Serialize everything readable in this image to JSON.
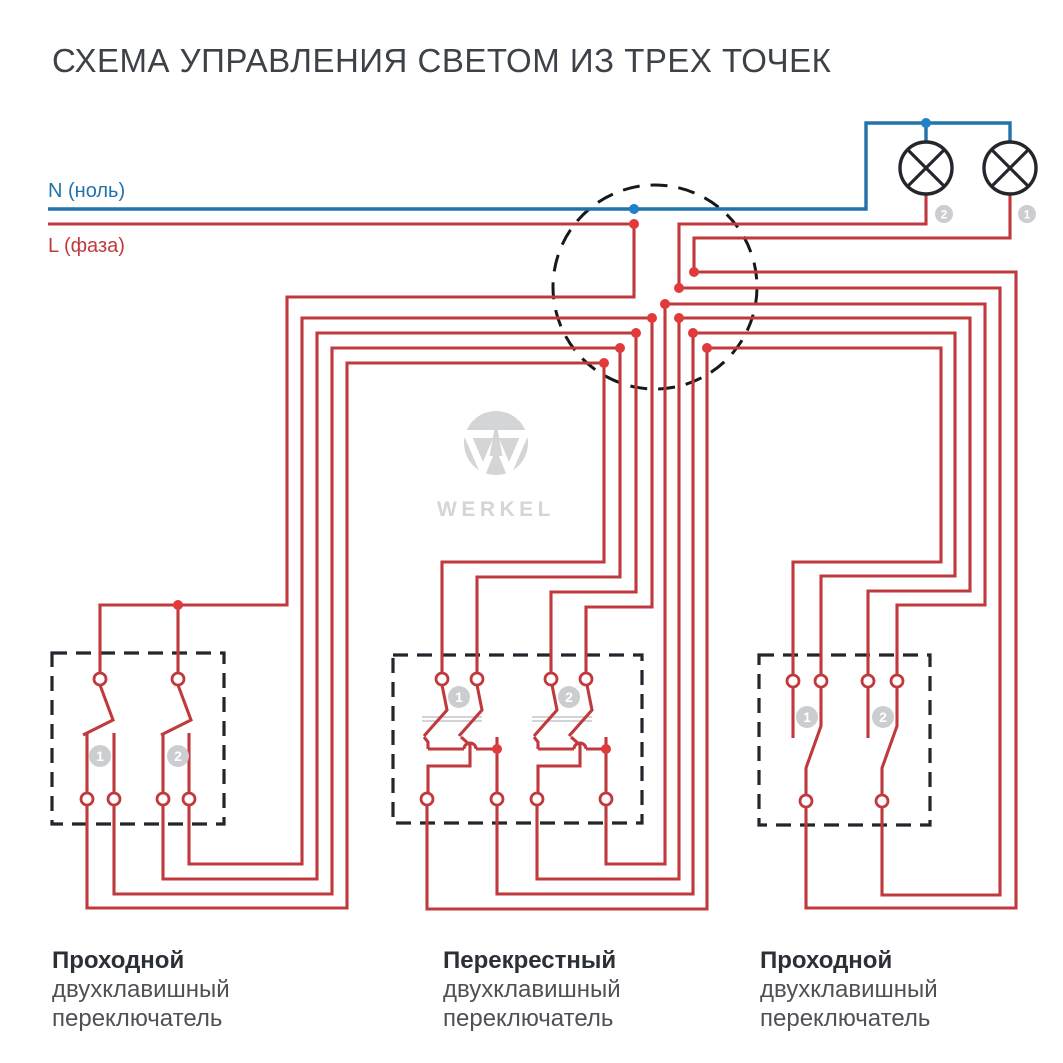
{
  "title": "СХЕМА УПРАВЛЕНИЯ СВЕТОМ ИЗ ТРЕХ ТОЧЕК",
  "wire_labels": {
    "neutral": "N (ноль)",
    "phase": "L (фаза)"
  },
  "logo": {
    "text": "WERKEL"
  },
  "switch_captions": [
    {
      "line1": "Проходной",
      "line2": "двухклавишный",
      "line3": "переключатель"
    },
    {
      "line1": "Перекрестный",
      "line2": "двухклавишный",
      "line3": "переключатель"
    },
    {
      "line1": "Проходной",
      "line2": "двухклавишный",
      "line3": "переключатель"
    }
  ],
  "colors": {
    "red": "#c03a3d",
    "red_dot": "#e13a3a",
    "blue": "#2173a9",
    "blue_dot": "#2080c8",
    "dark": "#23262c",
    "junction": "#16181c",
    "badge": "#cbcdd0",
    "badge_text": "#ffffff",
    "logo_gray": "#d3d5d7",
    "coupler": "#b9bbbd"
  },
  "diagram": {
    "boxes": [
      {
        "x": 52,
        "y": 653,
        "w": 172,
        "h": 171
      },
      {
        "x": 393,
        "y": 655,
        "w": 249,
        "h": 168
      },
      {
        "x": 759,
        "y": 655,
        "w": 171,
        "h": 170
      }
    ],
    "junction": {
      "cx": 655,
      "cy": 287,
      "r": 102
    },
    "lamps": [
      {
        "cx": 926,
        "cy": 168,
        "r": 26
      },
      {
        "cx": 1010,
        "cy": 168,
        "r": 26
      }
    ],
    "blue_wires": [
      [
        [
          48,
          209
        ],
        [
          866,
          209
        ],
        [
          866,
          123
        ],
        [
          1010,
          123
        ],
        [
          1010,
          142
        ]
      ],
      [
        [
          926,
          123
        ],
        [
          926,
          142
        ]
      ]
    ],
    "red_wires": [
      [
        [
          48,
          224
        ],
        [
          634,
          224
        ]
      ],
      [
        [
          634,
          224
        ],
        [
          634,
          297
        ],
        [
          287,
          297
        ],
        [
          287,
          605
        ],
        [
          100,
          605
        ],
        [
          100,
          673
        ]
      ],
      [
        [
          178,
          605
        ],
        [
          178,
          673
        ]
      ],
      [
        [
          100,
          685
        ],
        [
          113,
          720
        ],
        [
          83,
          735
        ]
      ],
      [
        [
          178,
          685
        ],
        [
          191,
          720
        ],
        [
          161,
          735
        ]
      ],
      [
        [
          87,
          733
        ],
        [
          87,
          793
        ]
      ],
      [
        [
          114,
          733
        ],
        [
          114,
          793
        ]
      ],
      [
        [
          163,
          733
        ],
        [
          163,
          793
        ]
      ],
      [
        [
          189,
          733
        ],
        [
          189,
          793
        ]
      ],
      [
        [
          87,
          805
        ],
        [
          87,
          908
        ],
        [
          347,
          908
        ],
        [
          347,
          363
        ],
        [
          604,
          363
        ]
      ],
      [
        [
          114,
          805
        ],
        [
          114,
          894
        ],
        [
          332,
          894
        ],
        [
          332,
          348
        ],
        [
          620,
          348
        ]
      ],
      [
        [
          163,
          805
        ],
        [
          163,
          879
        ],
        [
          317,
          879
        ],
        [
          317,
          333
        ],
        [
          636,
          333
        ]
      ],
      [
        [
          189,
          805
        ],
        [
          189,
          864
        ],
        [
          302,
          864
        ],
        [
          302,
          318
        ],
        [
          652,
          318
        ]
      ],
      [
        [
          604,
          363
        ],
        [
          604,
          562
        ],
        [
          442,
          562
        ],
        [
          442,
          673
        ]
      ],
      [
        [
          620,
          348
        ],
        [
          620,
          577
        ],
        [
          477,
          577
        ],
        [
          477,
          673
        ]
      ],
      [
        [
          636,
          333
        ],
        [
          636,
          592
        ],
        [
          551,
          592
        ],
        [
          551,
          673
        ]
      ],
      [
        [
          652,
          318
        ],
        [
          652,
          607
        ],
        [
          586,
          607
        ],
        [
          586,
          673
        ]
      ],
      [
        [
          442,
          685
        ],
        [
          447,
          710
        ],
        [
          424,
          736
        ]
      ],
      [
        [
          477,
          685
        ],
        [
          482,
          710
        ],
        [
          459,
          736
        ]
      ],
      [
        [
          552,
          685
        ],
        [
          557,
          710
        ],
        [
          534,
          736
        ]
      ],
      [
        [
          587,
          685
        ],
        [
          592,
          710
        ],
        [
          569,
          736
        ]
      ],
      [
        [
          424,
          737
        ],
        [
          428,
          742
        ],
        [
          428,
          749
        ]
      ],
      [
        [
          428,
          749
        ],
        [
          464,
          749
        ]
      ],
      [
        [
          476,
          749
        ],
        [
          497,
          749
        ]
      ],
      [
        [
          497,
          749
        ],
        [
          497,
          737
        ]
      ],
      [
        [
          497,
          749
        ],
        [
          497,
          793
        ]
      ],
      [
        [
          461,
          737
        ],
        [
          470,
          745
        ],
        [
          470,
          766
        ],
        [
          428,
          766
        ],
        [
          428,
          793
        ]
      ],
      [
        [
          534,
          737
        ],
        [
          538,
          742
        ],
        [
          538,
          749
        ]
      ],
      [
        [
          538,
          749
        ],
        [
          574,
          749
        ]
      ],
      [
        [
          586,
          749
        ],
        [
          606,
          749
        ]
      ],
      [
        [
          606,
          749
        ],
        [
          606,
          737
        ]
      ],
      [
        [
          606,
          749
        ],
        [
          606,
          793
        ]
      ],
      [
        [
          571,
          737
        ],
        [
          580,
          745
        ],
        [
          580,
          766
        ],
        [
          538,
          766
        ],
        [
          538,
          793
        ]
      ],
      [
        [
          427,
          805
        ],
        [
          427,
          909
        ],
        [
          707,
          909
        ],
        [
          707,
          348
        ]
      ],
      [
        [
          497,
          805
        ],
        [
          497,
          894
        ],
        [
          693,
          894
        ],
        [
          693,
          333
        ]
      ],
      [
        [
          537,
          805
        ],
        [
          537,
          879
        ],
        [
          679,
          879
        ],
        [
          679,
          318
        ]
      ],
      [
        [
          606,
          805
        ],
        [
          606,
          864
        ],
        [
          665,
          864
        ],
        [
          665,
          304
        ]
      ],
      [
        [
          665,
          304
        ],
        [
          985,
          304
        ],
        [
          985,
          605
        ],
        [
          897,
          605
        ],
        [
          897,
          675
        ]
      ],
      [
        [
          679,
          318
        ],
        [
          970,
          318
        ],
        [
          970,
          591
        ],
        [
          868,
          591
        ],
        [
          868,
          675
        ]
      ],
      [
        [
          693,
          333
        ],
        [
          955,
          333
        ],
        [
          955,
          576
        ],
        [
          821,
          576
        ],
        [
          821,
          675
        ]
      ],
      [
        [
          707,
          348
        ],
        [
          941,
          348
        ],
        [
          941,
          562
        ],
        [
          793,
          562
        ],
        [
          793,
          675
        ]
      ],
      [
        [
          793,
          687
        ],
        [
          793,
          738
        ]
      ],
      [
        [
          868,
          687
        ],
        [
          868,
          738
        ]
      ],
      [
        [
          821,
          687
        ],
        [
          821,
          726
        ],
        [
          806,
          768
        ],
        [
          806,
          795
        ]
      ],
      [
        [
          897,
          687
        ],
        [
          897,
          726
        ],
        [
          882,
          768
        ],
        [
          882,
          795
        ]
      ],
      [
        [
          806,
          807
        ],
        [
          806,
          908
        ],
        [
          1016,
          908
        ],
        [
          1016,
          272
        ],
        [
          694,
          272
        ]
      ],
      [
        [
          882,
          807
        ],
        [
          882,
          895
        ],
        [
          1000,
          895
        ],
        [
          1000,
          288
        ],
        [
          679,
          288
        ]
      ],
      [
        [
          1010,
          194
        ],
        [
          1010,
          238
        ],
        [
          694,
          238
        ],
        [
          694,
          272
        ]
      ],
      [
        [
          926,
          194
        ],
        [
          926,
          224
        ],
        [
          679,
          224
        ],
        [
          679,
          288
        ]
      ]
    ],
    "hops": [
      {
        "x": 470,
        "y": 749,
        "r": 6
      },
      {
        "x": 580,
        "y": 749,
        "r": 6
      }
    ],
    "coupler_lines": [
      [
        [
          422,
          717
        ],
        [
          482,
          717
        ]
      ],
      [
        [
          422,
          721
        ],
        [
          482,
          721
        ]
      ],
      [
        [
          532,
          717
        ],
        [
          592,
          717
        ]
      ],
      [
        [
          532,
          721
        ],
        [
          592,
          721
        ]
      ]
    ],
    "terminals": [
      [
        100,
        679
      ],
      [
        178,
        679
      ],
      [
        87,
        799
      ],
      [
        114,
        799
      ],
      [
        163,
        799
      ],
      [
        189,
        799
      ],
      [
        442,
        679
      ],
      [
        477,
        679
      ],
      [
        551,
        679
      ],
      [
        586,
        679
      ],
      [
        427,
        799
      ],
      [
        497,
        799
      ],
      [
        537,
        799
      ],
      [
        606,
        799
      ],
      [
        793,
        681
      ],
      [
        821,
        681
      ],
      [
        868,
        681
      ],
      [
        897,
        681
      ],
      [
        806,
        801
      ],
      [
        882,
        801
      ]
    ],
    "red_dots": [
      [
        634,
        224
      ],
      [
        178,
        605
      ],
      [
        694,
        272
      ],
      [
        679,
        288
      ],
      [
        665,
        304
      ],
      [
        652,
        318
      ],
      [
        679,
        318
      ],
      [
        636,
        333
      ],
      [
        693,
        333
      ],
      [
        620,
        348
      ],
      [
        707,
        348
      ],
      [
        604,
        363
      ],
      [
        497,
        749
      ],
      [
        606,
        749
      ]
    ],
    "blue_dots": [
      [
        634,
        209
      ],
      [
        926,
        123
      ]
    ],
    "badges": [
      {
        "x": 944,
        "y": 214,
        "r": 9,
        "fs": 12,
        "label": "2"
      },
      {
        "x": 1027,
        "y": 214,
        "r": 9,
        "fs": 12,
        "label": "1"
      },
      {
        "x": 100,
        "y": 756,
        "r": 11,
        "fs": 14,
        "label": "1"
      },
      {
        "x": 178,
        "y": 756,
        "r": 11,
        "fs": 14,
        "label": "2"
      },
      {
        "x": 459,
        "y": 697,
        "r": 11,
        "fs": 14,
        "label": "1"
      },
      {
        "x": 569,
        "y": 697,
        "r": 11,
        "fs": 14,
        "label": "2"
      },
      {
        "x": 807,
        "y": 717,
        "r": 11,
        "fs": 14,
        "label": "1"
      },
      {
        "x": 883,
        "y": 717,
        "r": 11,
        "fs": 14,
        "label": "2"
      }
    ],
    "logo_geom": {
      "cx": 496,
      "cy": 443,
      "r": 32,
      "band": {
        "x": 463,
        "y": 430,
        "w": 66,
        "h": 8
      },
      "w_path": [
        [
          468,
          436
        ],
        [
          483,
          471
        ],
        [
          496,
          440
        ],
        [
          509,
          471
        ],
        [
          524,
          436
        ]
      ],
      "spike": [
        [
          496,
          421
        ],
        [
          489.5,
          456
        ],
        [
          502.5,
          456
        ]
      ],
      "text_x": 496,
      "text_y": 516,
      "text_fs": 21
    }
  }
}
